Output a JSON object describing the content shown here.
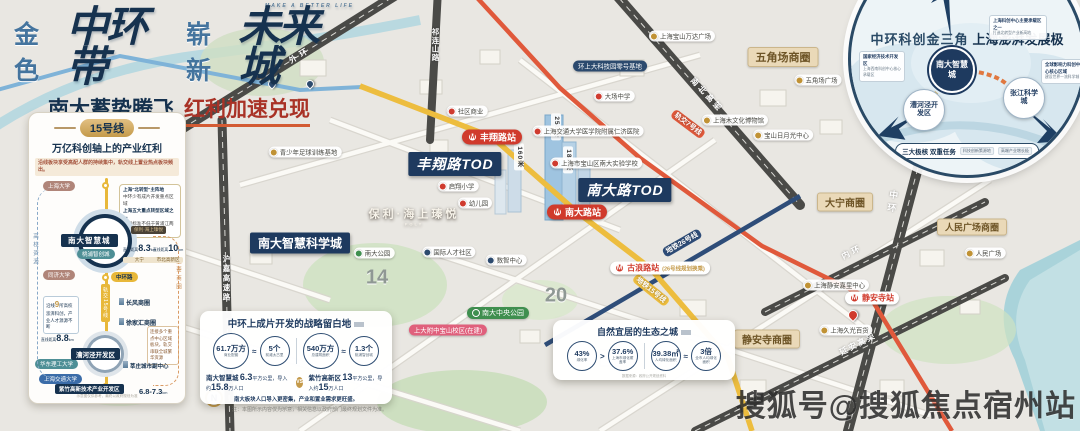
{
  "header": {
    "title": {
      "p1": "金色",
      "p2": "中环带",
      "p3": "崭新",
      "p4": "未来城",
      "en": "MAKE A BETTER LIFE"
    },
    "subtitle": {
      "left": "南大蓄势腾飞",
      "right": "红利加速兑现"
    }
  },
  "panel": {
    "badge": "15号线",
    "title": "万亿科创轴上的产业红利",
    "note": "沿线板块享受高配人群的持续集中，轨交线上置业热点板块频出。",
    "callout": {
      "l1": "上海\"北转型\"主阵地",
      "l2": "中环少有成片开发重点区域",
      "l3": "上海五大重点转型区域之一",
      "l4": "规划标准不低于黄浦江两岸开发标准"
    },
    "stations": {
      "u1": "上海大学",
      "u2": "同济大学",
      "u3": "华东理工大学",
      "u4": "上海交通大学"
    },
    "line_label": "轨交15号线",
    "node1": {
      "name": "南大智慧城",
      "sub": "桃浦智创城",
      "project": "保利·海上瑧悦"
    },
    "dist": {
      "prefix": "直线距离",
      "d1": "8.3",
      "d1_unit": "km",
      "d1_target": "大宁",
      "d2": "10",
      "d2_unit": "km",
      "d2_target": "市北高新区",
      "d3": "8.8",
      "d3_unit": "km",
      "d4": "6.8-7.3",
      "d4_unit": "km"
    },
    "cross_road": "中环路",
    "biz1": "长风商圈",
    "biz2": "徐家汇商圈",
    "node2": "漕河泾开发区",
    "sub_center": "莘庄城市副中心",
    "node3": "紫竹高新技术产业开发区",
    "left_axis": "高校资源",
    "right_axis": "重要商圈",
    "left_box": {
      "pre": "沿线",
      "num": "9",
      "post": "所高校",
      "line2": "澎湃科创，产业人才源源不断"
    },
    "right_box": "连接多个重点中心区域板块，轨交串联全城繁华资源",
    "footnote": "示意图仅供参考，最终以政府规划为准"
  },
  "map": {
    "sci_city": "南大智慧科学城",
    "tod1": "丰翔路TOD",
    "tod2": "南大路TOD",
    "station1": "丰翔路站",
    "station2": "南大路站",
    "station3": "古浪路站",
    "station3_note": "(26号线规划换乘)",
    "station4": "静安寺站",
    "circle1": "五角场商圈",
    "circle2": "大宁商圈",
    "circle3": "人民广场商圈",
    "circle4": "静安寺商圈",
    "park_badge": "南大中央公园",
    "project": "保利·海上瑧悦",
    "project_en": "POLY",
    "heights": {
      "h1": "250米",
      "h2": "160米",
      "h3": "180米"
    },
    "numerals": {
      "n1": "14",
      "n2": "20"
    },
    "roads": {
      "r1": "外环",
      "r2": "沪嘉高速路",
      "r3": "祁连山路",
      "r4": "南北高架",
      "r5": "中环",
      "r6": "内环",
      "r7": "延安高架",
      "m15": "地铁15号线",
      "m7": "轨交7号线",
      "m26": "地铁26号线"
    },
    "pois": [
      {
        "label": "青少年足球训练基地",
        "type": "gold"
      },
      {
        "label": "社区商业",
        "type": "red"
      },
      {
        "label": "环上大科技园零号基地",
        "type": "navy"
      },
      {
        "label": "大场中学",
        "type": "red"
      },
      {
        "label": "上海宝山万达广场",
        "type": "gold"
      },
      {
        "label": "五角场广场",
        "type": "gold"
      },
      {
        "label": "上海木文化博物馆",
        "type": "gold"
      },
      {
        "label": "宝山日月光中心",
        "type": "gold"
      },
      {
        "label": "上海交通大学医学院附属仁济医院",
        "type": "red"
      },
      {
        "label": "上海市宝山区南大实验学校",
        "type": "red"
      },
      {
        "label": "启翔小学",
        "type": "red"
      },
      {
        "label": "幼儿园",
        "type": "red"
      },
      {
        "label": "南大公园",
        "type": "green"
      },
      {
        "label": "国际人才社区",
        "type": "navy"
      },
      {
        "label": "数智中心",
        "type": "navy"
      },
      {
        "label": "上大附中宝山校区(在建)",
        "type": "pink"
      },
      {
        "label": "上海静安嘉里中心",
        "type": "gold"
      },
      {
        "label": "上海久光百货",
        "type": "gold"
      },
      {
        "label": "人民广场",
        "type": "gold"
      }
    ]
  },
  "cards": {
    "card1": {
      "title": "中环上成片开发的战略留白地",
      "s1_value": "61.7万方",
      "s1_label": "商业配套",
      "s1_rel": "≈",
      "s2_value": "5个",
      "s2_label": "前滩太古里",
      "s3_value": "540万方",
      "s3_label": "总建筑面积",
      "s3_rel": "≈",
      "s4_value": "1.3个",
      "s4_label": "桃浦智创城",
      "vs": "VS",
      "left_name": "南大智慧城",
      "left_a": "6.3",
      "left_mid": "平方公里，导入约",
      "left_b": "15.8",
      "left_post": "万人口",
      "right_name": "紫竹高新区",
      "right_a": "13",
      "right_mid": "平方公里，导入约",
      "right_b": "15",
      "right_post": "万人口",
      "conclusion": "南大板块人口导入更密集，产业和置业需求更旺盛。",
      "footnote": "数据来源：政府公开规划资料"
    },
    "card2": {
      "title": "自然宜居的生态之城",
      "s1_value": "43%",
      "s1_label": "绿化率",
      "s1_rel": ">",
      "s2_value": "37.6%",
      "s2_label": "上海市绿化覆盖率",
      "s3_value": "39.38㎡",
      "s3_label": "人均绿化面积",
      "s3_rel": "≈",
      "s4_value": "3倍",
      "s4_label": "全市人均绿化面积",
      "footnote": "数据来源：政府公开规划资料"
    }
  },
  "inset": {
    "title": "中环科创金三角",
    "title2": "上海澎湃发展极",
    "node1": "南大智慧城",
    "node2": "漕河泾开发区",
    "node3": "张江科学城",
    "box_left_title": "国家经济技术开发区",
    "box_left_sub": "上海西南科创中心核心承载区",
    "box_top_title": "上海科创中心主要承载区之一",
    "box_top_sub": "打造北转型产业新高地",
    "box_right_title": "全球影响力科创中心核心区域",
    "box_right_sub": "建设世界一流科学城",
    "bottom_title": "三大极核 双重任务",
    "bottom_chip1": "科技创新策源地",
    "bottom_chip2": "高端产业增长极"
  },
  "icons": {
    "metro": "M",
    "compass_n": "N"
  },
  "watermark": "搜狐号@搜狐焦点宿州站",
  "disclaimer": "注：本图所示内容仅为示意，相关信息以政府部门最终规划文件为准。"
}
